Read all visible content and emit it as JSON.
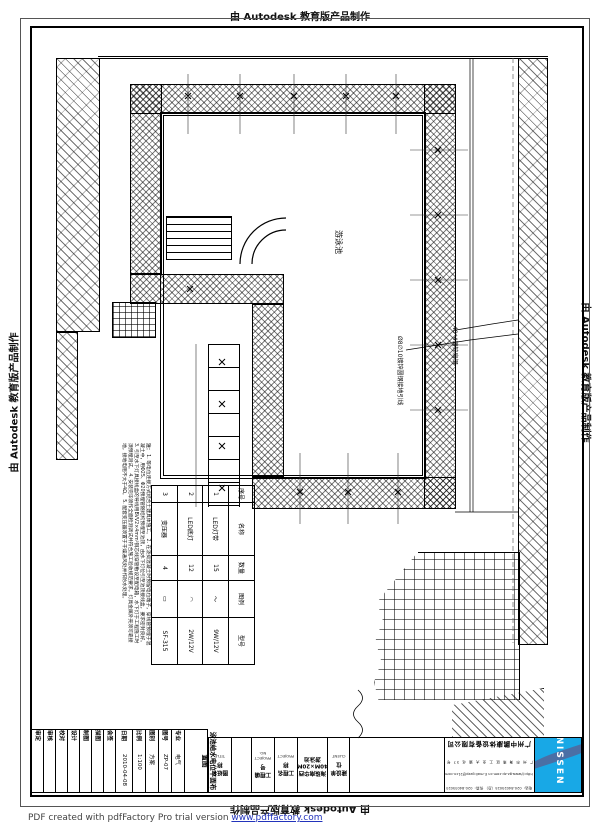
{
  "stamps": {
    "top": "由 Autodesk 教育版产品制作",
    "bottom": "由 Autodesk 教育版产品制作",
    "left": "由 Autodesk 教育版产品制作",
    "right": "由 Autodesk 教育版产品制作"
  },
  "pdf_notice": {
    "prefix": "PDF created with pdfFactory Pro trial version ",
    "link": "www.pdffactory.com"
  },
  "plan": {
    "pool_label": "游泳池",
    "callout_ground_rod": "Ø8∅10镀锌圆钢接地引线",
    "callout_flat_steel": "40*4镀锌扁钢"
  },
  "notes": {
    "title": "注：",
    "items": [
      "1. 等电位连接方式结合土建具体施工。",
      "2. 在浇捣混凝土时预留电位端子，穿线管预埋于混凝土中，用Φ25、Φ20预埋管随结构预埋至池顶，由水下灯位引至池顶接线盒，要求密封良好。",
      "3. 引至水下灯具接线盒的导线用BVV2×4mm²铜芯线穿管敷设至配电箱，水下灯于工程施工时须预埋测试。",
      "4. 安装完毕须作全面检测调试并符合施工验收规范要求，灯具金属外壳须可靠接地，接地电阻不大于4Ω。",
      "5. 配套变压器须置于干燥通风处并作防水处理。"
    ]
  },
  "legend": {
    "headers": [
      "序号",
      "名称",
      "数量",
      "图例",
      "型号"
    ],
    "rows": [
      {
        "no": "1",
        "name": "LED灯带",
        "qty": "15",
        "symbol": "～",
        "model": "9W/12V"
      },
      {
        "no": "2",
        "name": "LED底灯",
        "qty": "12",
        "symbol": "◠",
        "model": "2W/12V"
      },
      {
        "no": "3",
        "name": "变压器",
        "qty": "4",
        "symbol": "▭",
        "model": "SF-315"
      }
    ]
  },
  "strip": {
    "columns": [
      {
        "label": "审定",
        "value": ""
      },
      {
        "label": "审核",
        "value": ""
      },
      {
        "label": "校对",
        "value": ""
      },
      {
        "label": "设计",
        "value": ""
      },
      {
        "label": "制图",
        "value": ""
      },
      {
        "label": "描图",
        "value": ""
      },
      {
        "label": "会签",
        "value": ""
      },
      {
        "label": "日期",
        "value": "2010-04-08"
      },
      {
        "label": "比例",
        "value": "1:100"
      },
      {
        "label": "图别",
        "value": "方案"
      },
      {
        "label": "图号",
        "value": "ZP-07"
      },
      {
        "label": "专业",
        "value": "电气"
      }
    ],
    "title_value": "泳池给水电位平面布置图"
  },
  "titleblock": {
    "cells": [
      {
        "cn": "图纸名称",
        "en": "TITLE"
      },
      {
        "cn": "工程编号",
        "en": "PROJECT NO."
      },
      {
        "cn": "工程名称",
        "en": "PROJECT"
      },
      {
        "cn": "建设单位",
        "en": "CLIENT"
      }
    ],
    "project_name": "海珠南华西40M×20M游泳池",
    "company": {
      "name": "广州中鹏康体设备有限公司",
      "address": "广 州 市 海 珠 区 工 业 大 道 北 37 号",
      "web": "http://www.gz-zp.com.cn  E-mail:gzzp@21cn.com",
      "phone": "电话：020-84025025（总）  传真：020-84035025"
    },
    "logo_text": "NISSEN"
  }
}
